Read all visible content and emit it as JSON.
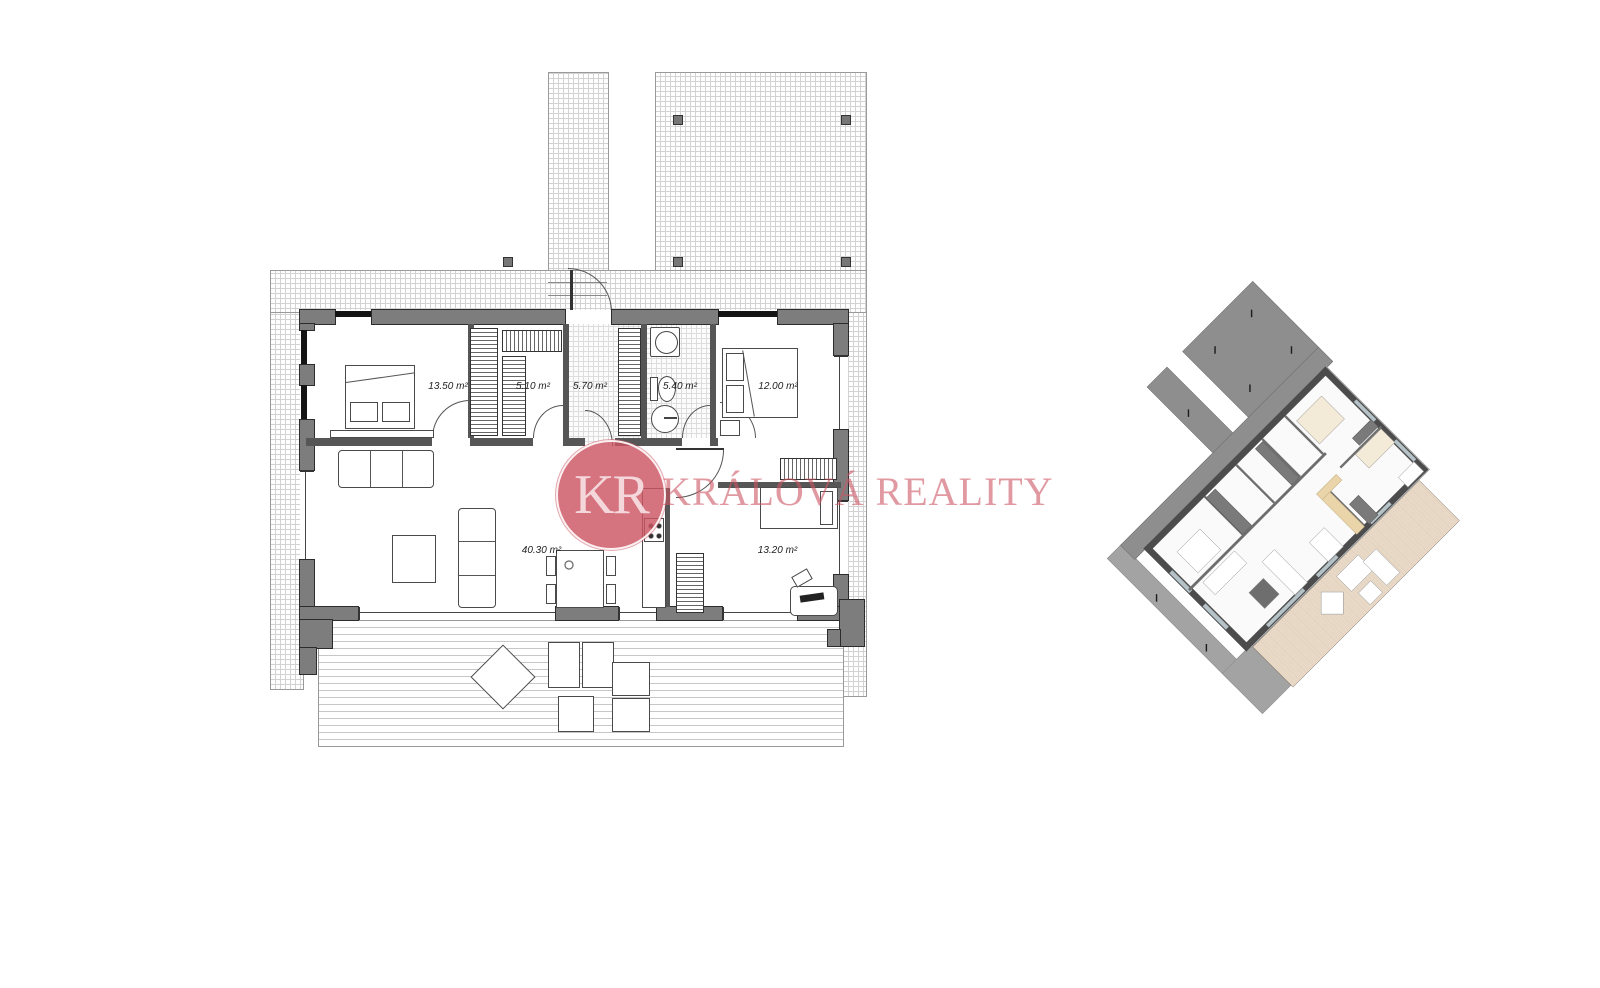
{
  "watermark": {
    "monogram": "KR",
    "brand": "KRÁLOVÁ REALITY",
    "circle_color": "#cc5461",
    "text_color": "#cd5562"
  },
  "floor_plan": {
    "rooms": [
      {
        "name": "bedroom-left",
        "area_label": "13.50 m²"
      },
      {
        "name": "closet",
        "area_label": "5.10 m²"
      },
      {
        "name": "hallway",
        "area_label": "5.70 m²"
      },
      {
        "name": "bathroom",
        "area_label": "5.40 m²"
      },
      {
        "name": "bedroom-right",
        "area_label": "12.00 m²"
      },
      {
        "name": "living-room",
        "area_label": "40.30 m²"
      },
      {
        "name": "study",
        "area_label": "13.20 m²"
      }
    ]
  }
}
